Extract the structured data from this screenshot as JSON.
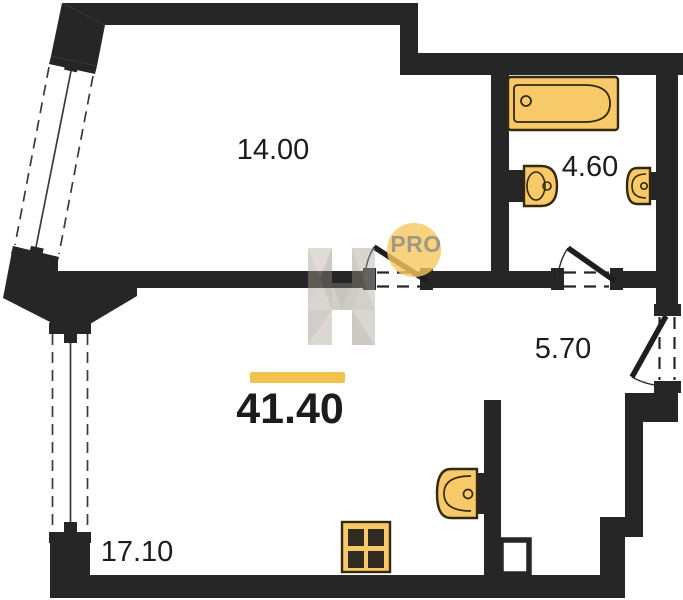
{
  "floorplan": {
    "total_area": "41.40",
    "rooms": [
      {
        "id": "room-top-left",
        "area": "14.00"
      },
      {
        "id": "bathroom",
        "area": "4.60"
      },
      {
        "id": "hallway",
        "area": "5.70"
      },
      {
        "id": "kitchen-living-room",
        "area": "17.10"
      }
    ],
    "watermark": {
      "letter": "Н",
      "badge": "PRO"
    },
    "fixtures": [
      "bathtub",
      "toilet",
      "bathroom-sink",
      "kitchen-sink",
      "stove",
      "ventilation-shaft"
    ],
    "windows_count": 2,
    "doors_count": 3,
    "colors": {
      "wall": "#262626",
      "fixture_fill": "#F8C968",
      "fixture_stroke": "#32290f",
      "accent_bar": "#F2C24F",
      "watermark_circle": "#F6C75B",
      "watermark_letter": "#9c968c",
      "text": "#1c1c1c"
    }
  }
}
